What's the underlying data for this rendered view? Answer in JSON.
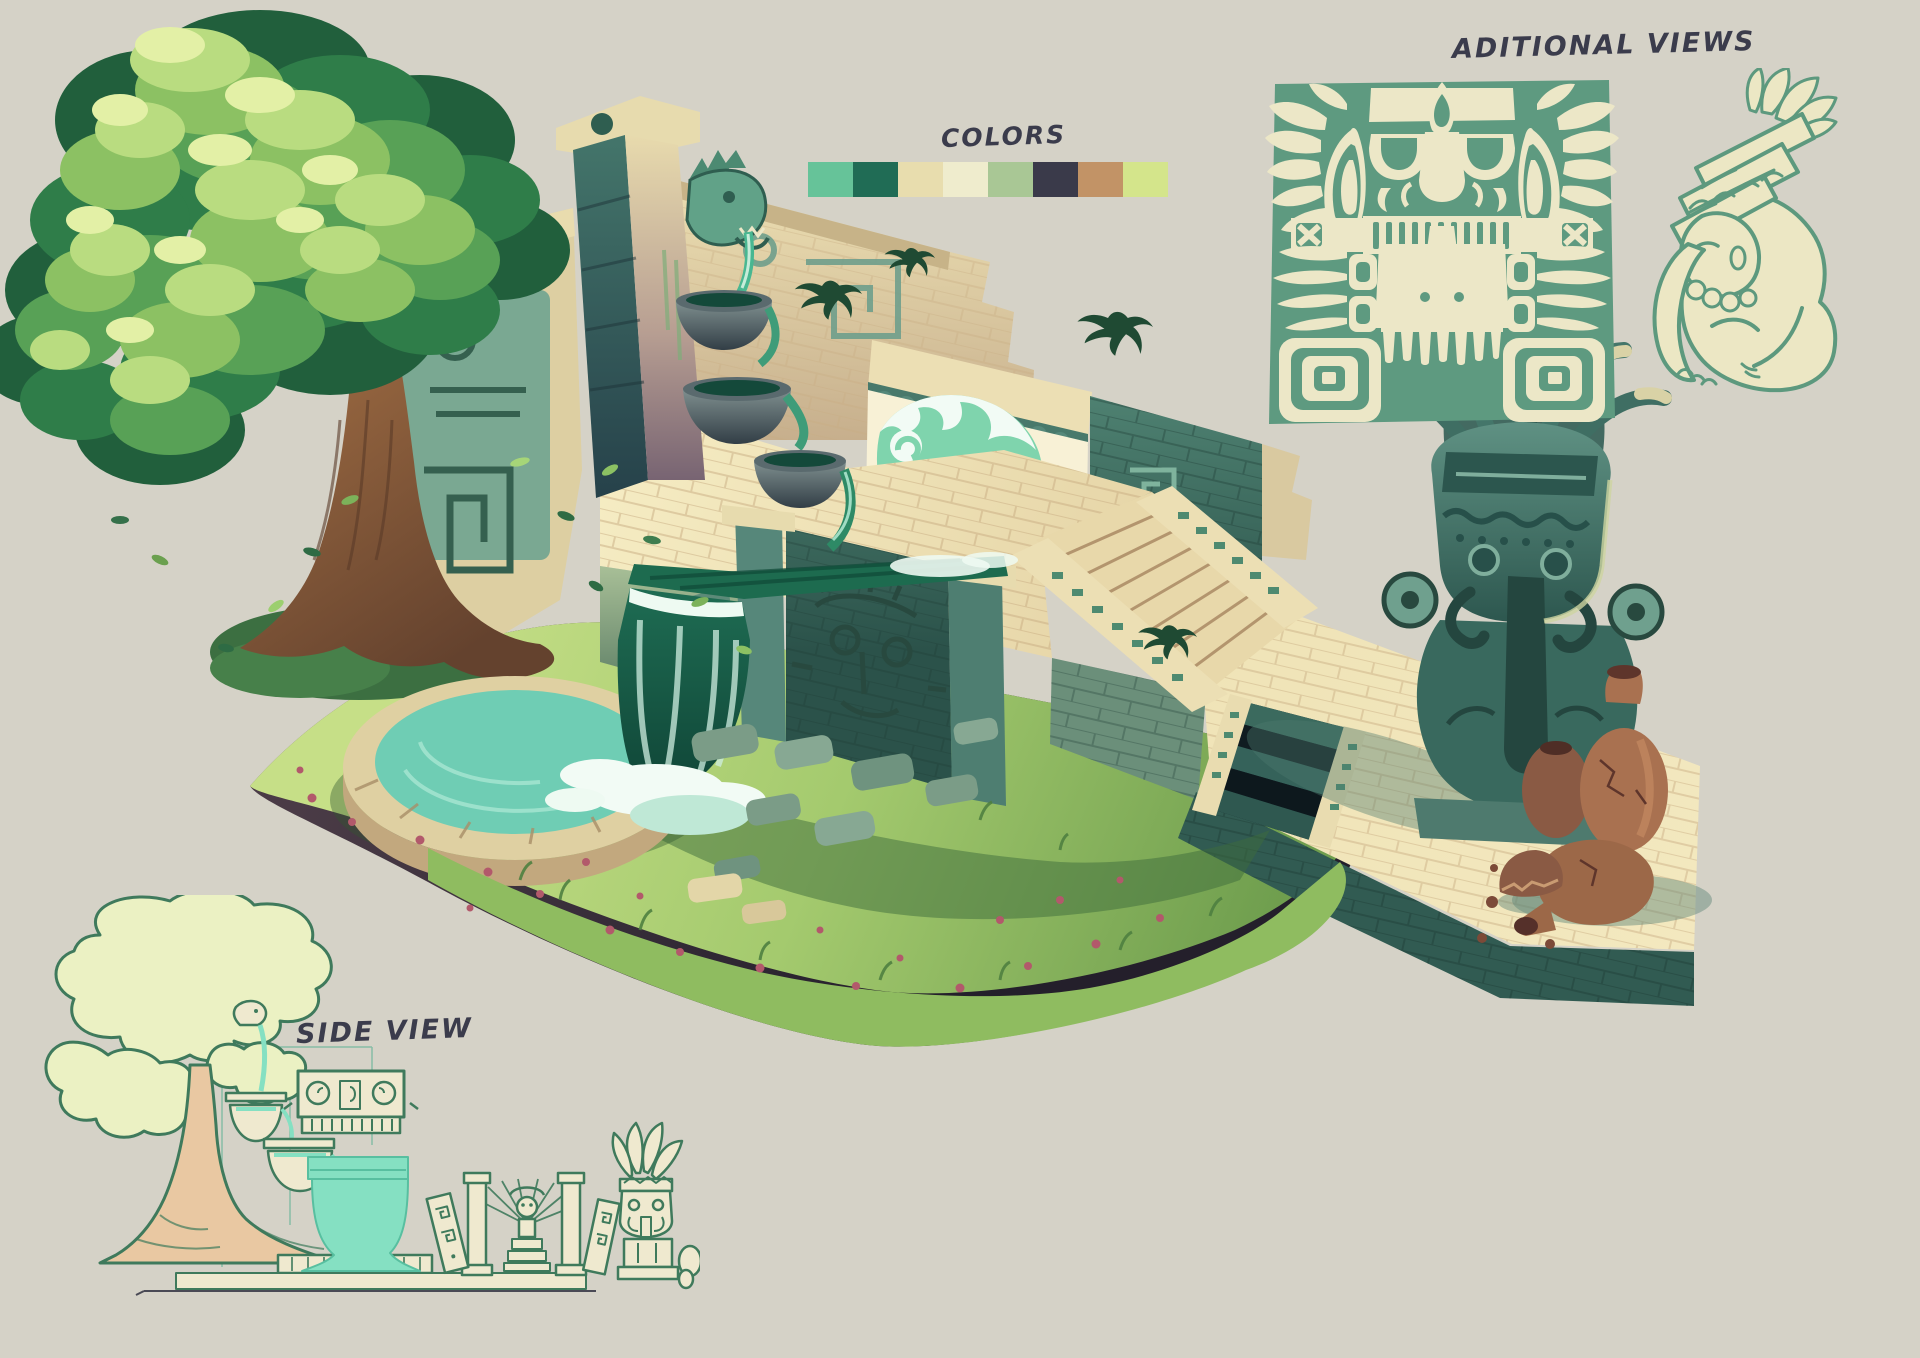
{
  "canvas": {
    "width": 1920,
    "height": 1358,
    "background": "#d5d2c7",
    "ink_color": "#3b3c4c"
  },
  "palette": {
    "title": "COLORS",
    "swatches": [
      {
        "name": "mint",
        "hex": "#66c399"
      },
      {
        "name": "dark-green",
        "hex": "#206c55"
      },
      {
        "name": "sand",
        "hex": "#e8ddae"
      },
      {
        "name": "cream",
        "hex": "#efeccd"
      },
      {
        "name": "sage",
        "hex": "#a9c795"
      },
      {
        "name": "charcoal",
        "hex": "#3a3a4a"
      },
      {
        "name": "tan",
        "hex": "#c29366"
      },
      {
        "name": "lime",
        "hex": "#d4e58b"
      }
    ]
  },
  "additional_views": {
    "title": "ADITIONAL VIEWS",
    "items": [
      {
        "name": "stone-mask-relief"
      },
      {
        "name": "seated-figure-carving"
      }
    ]
  },
  "side_view": {
    "title": "SIDE VIEW"
  },
  "illustration": {
    "subject": "Isometric Aztec temple fountain on a floating grass island",
    "elements": [
      "tree",
      "serpent-fountain-column",
      "cascade-bowls",
      "wave-fountain",
      "water-channel",
      "waterfall",
      "round-pool",
      "paved-platform",
      "stairs",
      "sunken-staircase",
      "carved-deity-wall",
      "totem-statue",
      "clay-amphoras",
      "grass-island",
      "pink-flowers",
      "falling-leaves"
    ]
  }
}
